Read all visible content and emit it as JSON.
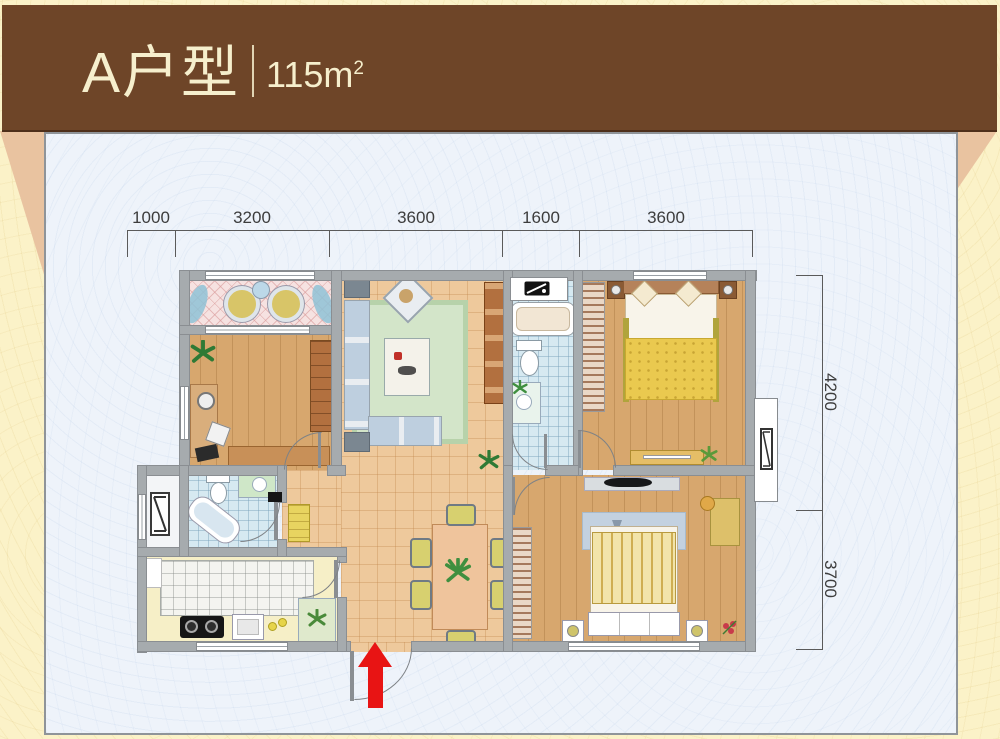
{
  "header": {
    "title": "A户型",
    "area_value": "115m",
    "area_exponent": "2"
  },
  "dimensions": {
    "top": [
      "1000",
      "3200",
      "3600",
      "1600",
      "3600"
    ],
    "right": [
      "4200",
      "3700"
    ]
  },
  "icons": {
    "entry_arrow": "red-arrow-up",
    "ac_unit": "boxed-diagonal-air-conditioner",
    "washer": "washing-machine-black-box",
    "plant": "green-leaf-star"
  },
  "colors": {
    "banner_bg": "#6e4528",
    "banner_text": "#f6efcd",
    "page_bg": "#fbf2c8",
    "fold": "#e9c3a0",
    "panel_bg": "#eef3fa",
    "panel_border": "#8f9499",
    "wall": "#a6abae",
    "wall_edge": "#8a8e92",
    "dim_line": "#5a5a5a",
    "dim_text": "#3d3d3d",
    "arrow_red": "#e81414",
    "wood": "#d7a76e",
    "tile": "#eec99c",
    "bath": "#d6e9f1",
    "pink": "#f6e2e1",
    "kitchen_tile": "#f4f4f0",
    "counter": "#f6efc7",
    "rug": "#d3e5c9",
    "rug_border": "#b7d2aa",
    "sofa": "#becfdf",
    "sofa_frame": "#e9edf1",
    "cabinet": "#b2703f",
    "hatch_base": "#ead8c6",
    "hatch_line": "#a5795c",
    "blanket_yellow": "#eac94f",
    "bed_white": "#f8f4ea",
    "headboard": "#b5825a",
    "chair_yellow": "#d7d06f",
    "table_tan": "#efc49c"
  }
}
